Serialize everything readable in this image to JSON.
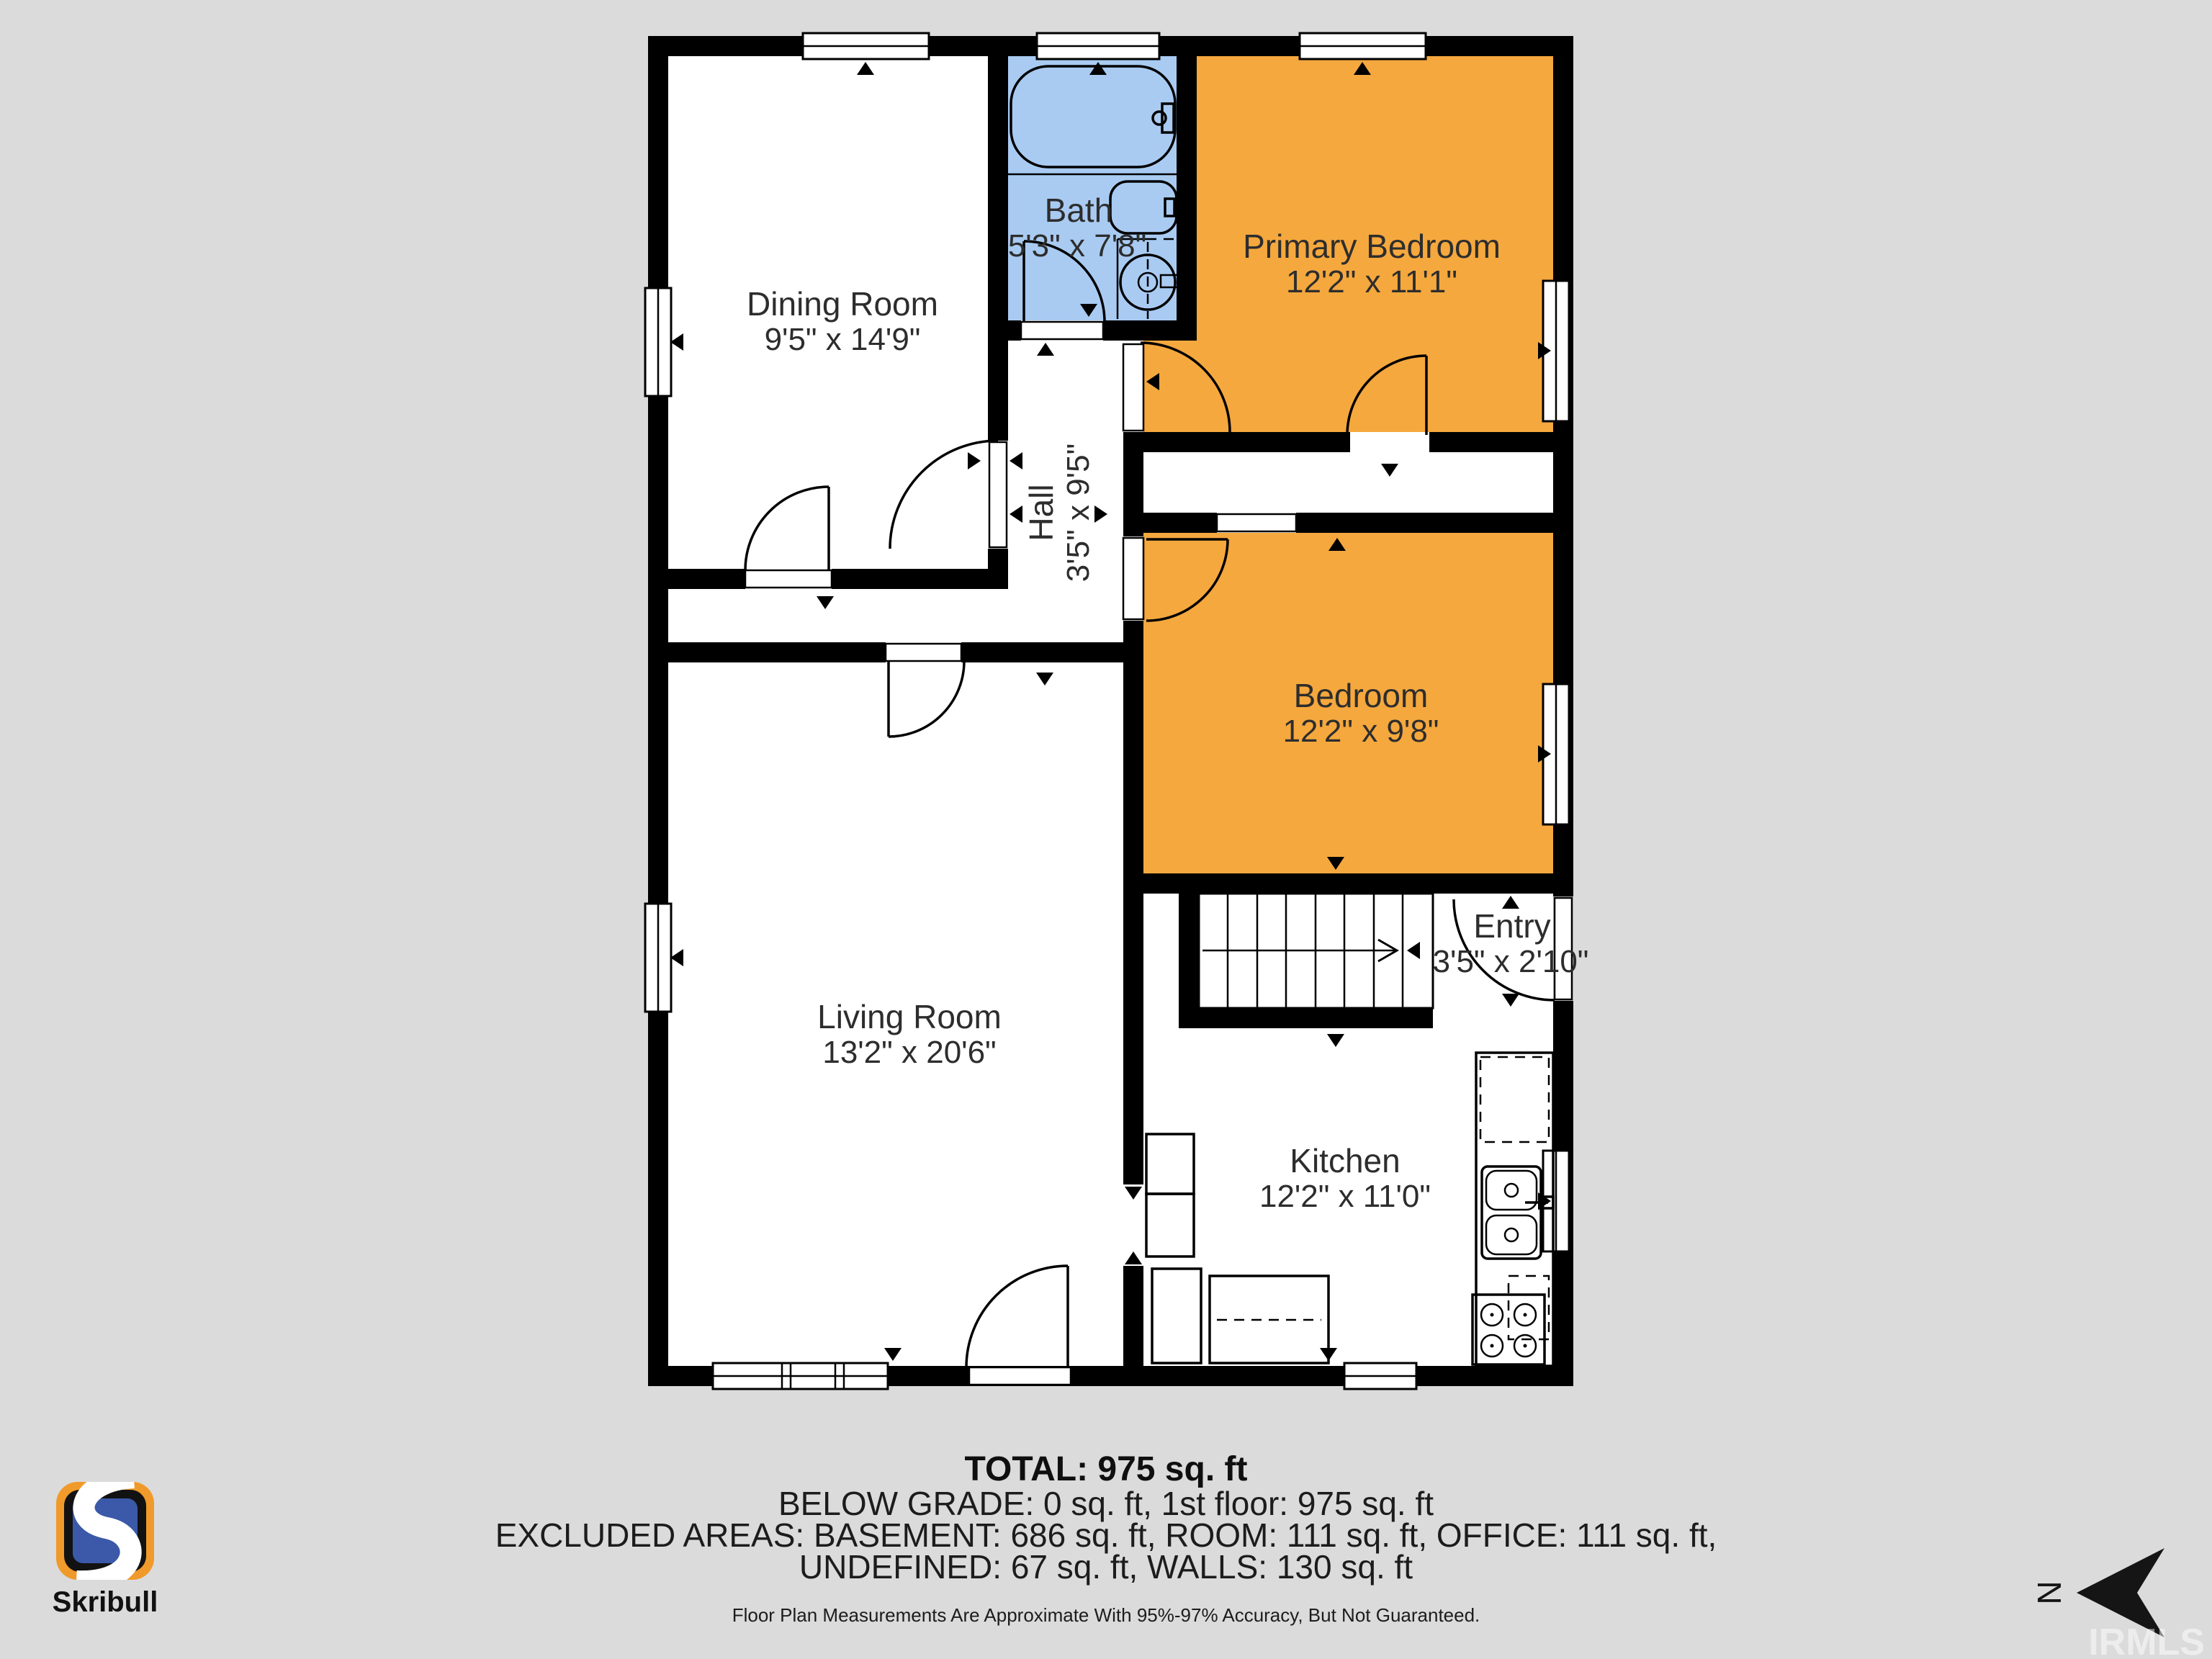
{
  "plan": {
    "rooms": [
      {
        "name": "Dining Room",
        "dims": "9'5\" x 14'9\""
      },
      {
        "name": "Bath",
        "dims": "5'3\" x 7'8\""
      },
      {
        "name": "Primary Bedroom",
        "dims": "12'2\" x 11'1\""
      },
      {
        "name": "Hall",
        "dims": "3'5\" x 9'5\""
      },
      {
        "name": "Bedroom",
        "dims": "12'2\" x 9'8\""
      },
      {
        "name": "Entry",
        "dims": "3'5\" x 2'10\""
      },
      {
        "name": "Living Room",
        "dims": "13'2\" x 20'6\""
      },
      {
        "name": "Kitchen",
        "dims": "12'2\" x 11'0\""
      }
    ],
    "colors": {
      "background": "#dbdbdb",
      "walls": "#000000",
      "bedroom_fill": "#F5A83E",
      "bath_fill": "#A9CBF2",
      "room_fill": "#ffffff"
    }
  },
  "summary": {
    "total": "TOTAL: 975 sq. ft",
    "below_grade": "BELOW GRADE: 0 sq. ft, 1st floor: 975 sq. ft",
    "excluded": "EXCLUDED AREAS: BASEMENT: 686 sq. ft, ROOM: 111 sq. ft, OFFICE: 111 sq. ft,",
    "undefined_walls": "UNDEFINED: 67 sq. ft, WALLS: 130 sq. ft",
    "disclaimer": "Floor Plan Measurements Are Approximate With 95%-97% Accuracy, But Not Guaranteed."
  },
  "branding": {
    "logo_text": "Skribull",
    "watermark": "IRMLS",
    "north_label": "N",
    "logo_orange": "#F09A2B",
    "logo_blue": "#3B59A8"
  }
}
